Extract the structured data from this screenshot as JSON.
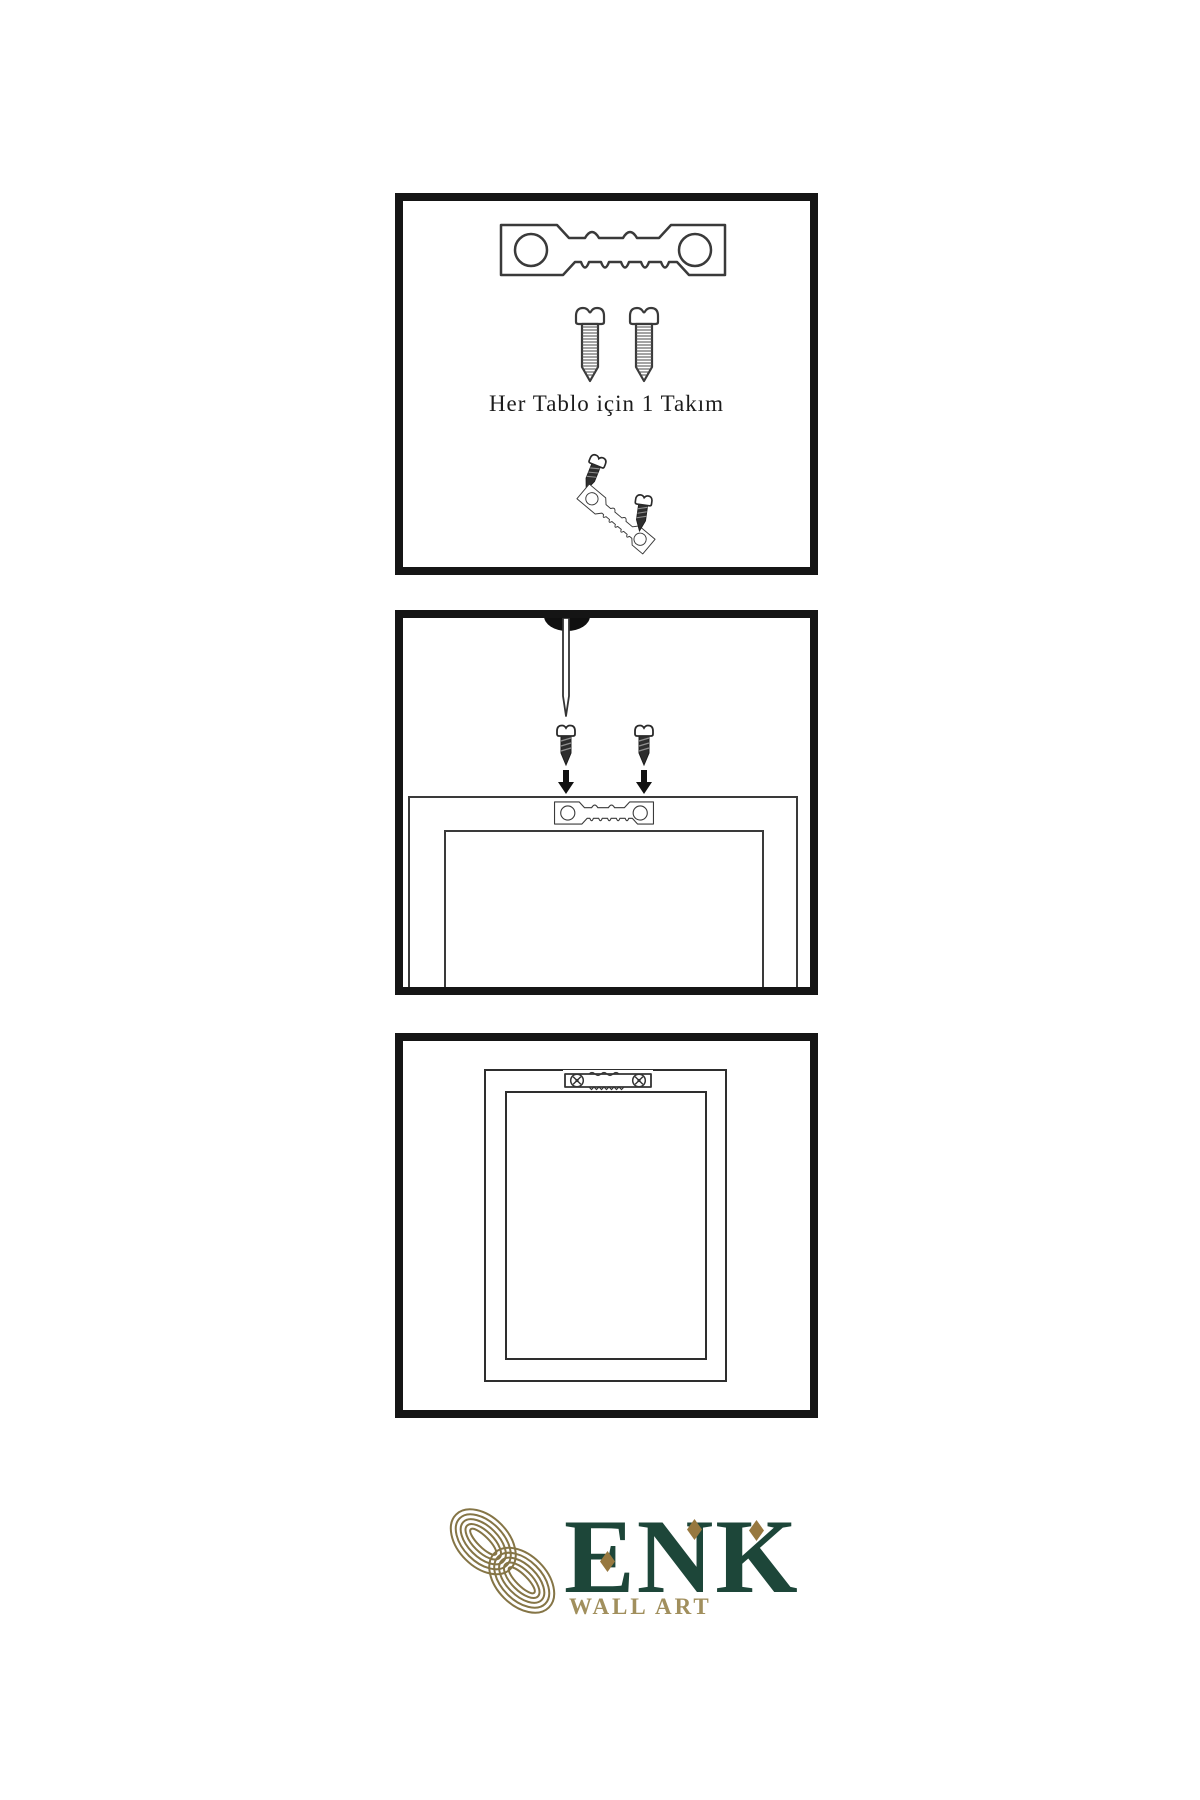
{
  "panels": {
    "step1": {
      "caption": "Her Tablo için 1 Takım"
    },
    "step2": {},
    "step3": {}
  },
  "brand": {
    "name": "ENK",
    "tagline": "WALL ART"
  },
  "hardware_icons": [
    "sawtooth-hanger-icon",
    "screw-icon",
    "nail-icon",
    "down-arrow-icon",
    "mounted-hanger-icon",
    "knot-logo-icon"
  ],
  "colors": {
    "background": "#ffffff",
    "panel_border": "#151515",
    "line_art": "#3a3a3a",
    "brand_green": "#1d4639",
    "brand_gold": "#a18f5d",
    "knot_gold": "#857546",
    "diamond_gold": "#97783f"
  }
}
